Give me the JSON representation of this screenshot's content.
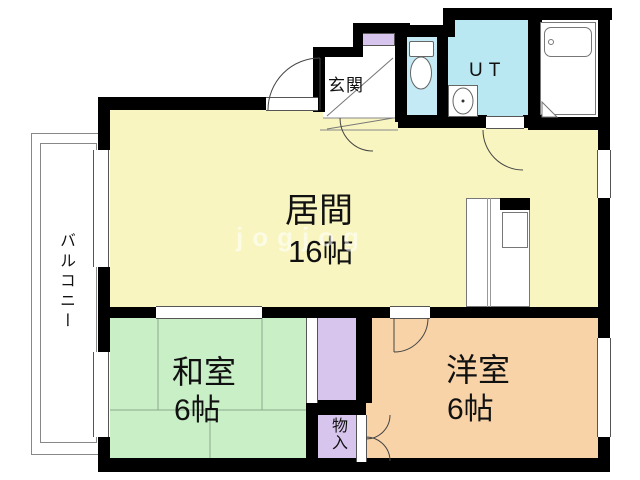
{
  "plan_title": "1LDK apartment floor plan",
  "rooms": {
    "living": {
      "name": "居間",
      "size": "16帖"
    },
    "japanese": {
      "name": "和室",
      "size": "6帖"
    },
    "western": {
      "name": "洋室",
      "size": "6帖"
    },
    "entrance": {
      "name": "玄関"
    },
    "utility": {
      "name": "UT"
    },
    "storage": {
      "name": "物入"
    },
    "balcony": {
      "name": "バルコニー"
    }
  },
  "watermark": {
    "text": "jogjog"
  },
  "colors": {
    "wall": "#000000",
    "living_floor": "#f8f5c0",
    "japanese_floor": "#c9efc7",
    "western_floor": "#f8d3a8",
    "closet": "#d7c5ee",
    "wet_area": "#c4ebf5",
    "balcony_line": "#888888"
  }
}
